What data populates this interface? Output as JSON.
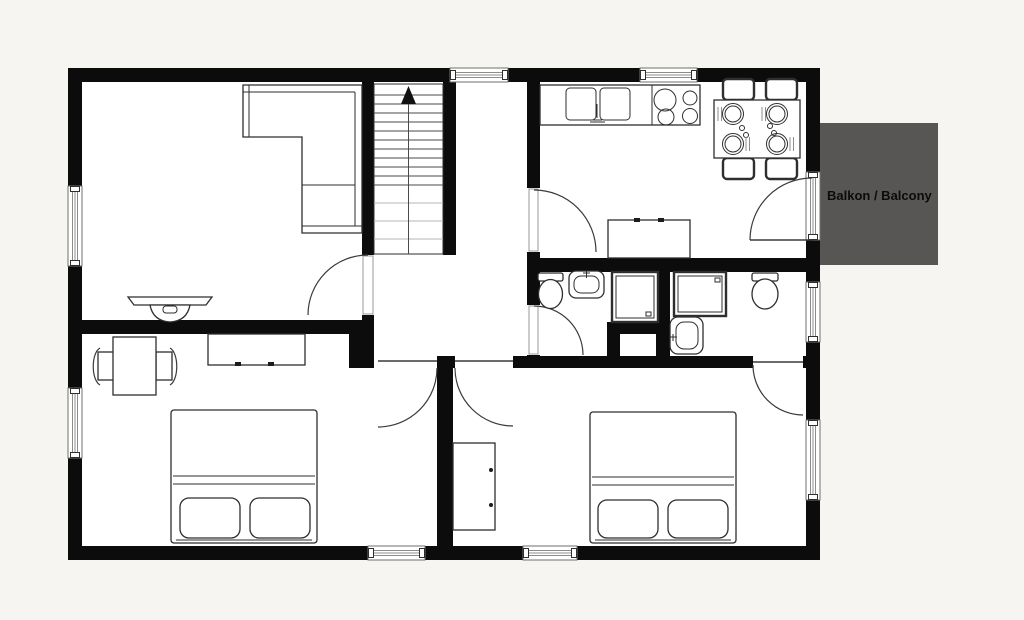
{
  "title": "Apartment floor plan",
  "balcony": {
    "label": "Balkon / Balcony"
  },
  "colors": {
    "bg": "#f6f5f2",
    "wall": "#0c0c0c",
    "line": "#2e2e2e",
    "soft": "#8c8c8c",
    "balcony": "#585654",
    "floor": "#ffffff",
    "label": "#0b0b0b"
  },
  "elements": [
    "staircase-up-arrow",
    "corner-sofa",
    "media-console",
    "kitchen-counter",
    "double-sink",
    "cooktop-4-burners",
    "dining-table-with-4-chairs",
    "kitchen-sideboard",
    "bathroom-1-toilet",
    "bathroom-1-washbasin",
    "bathroom-1-shower",
    "bathroom-2-shower",
    "bathroom-2-washbasin",
    "bathroom-2-toilet",
    "utility-shaft",
    "desk-with-2-chairs",
    "bedroom-1-dresser",
    "bedroom-1-double-bed",
    "bedroom-2-wardrobe",
    "bedroom-2-double-bed",
    "windows",
    "door-swings",
    "balcony-area"
  ]
}
